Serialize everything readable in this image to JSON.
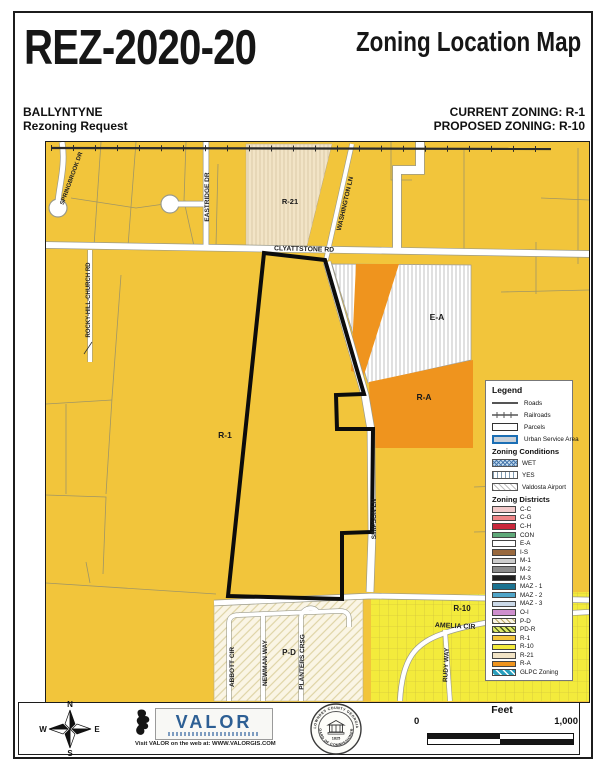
{
  "header": {
    "case_number": "REZ-2020-20",
    "map_title": "Zoning Location Map",
    "applicant": "BALLYNTYNE",
    "request_type": "Rezoning Request",
    "current_zoning_label": "CURRENT ZONING:  R-1",
    "proposed_zoning_label": "PROPOSED ZONING:  R-10"
  },
  "map": {
    "zone_labels": {
      "r21": "R-21",
      "ea": "E-A",
      "ra": "R-A",
      "r1": "R-1",
      "r10": "R-10",
      "pd": "P-D"
    },
    "road_labels": {
      "clyattstone": "CLYATTSTONE RD",
      "eastridge": "EASTRIDGE DR",
      "springbrook": "SPRINGBROOK DR",
      "rockyhill": "ROCKY-HILL-CHURCH RD",
      "washington": "WASHINGTON LN",
      "simpson": "SIMPSON LN",
      "amelia": "AMELIA CIR",
      "rudy": "RUDY WAY",
      "abbott": "ABBOTT CIR",
      "newman": "NEWMAN WAY",
      "planters": "PLANTERS CRSG"
    }
  },
  "legend": {
    "title": "Legend",
    "base_items": [
      {
        "label": "Roads"
      },
      {
        "label": "Railroads"
      },
      {
        "label": "Parcels"
      },
      {
        "label": "Urban Service Area"
      }
    ],
    "conditions_title": "Zoning Conditions",
    "conditions": [
      {
        "label": "WET",
        "color": "#C7DEF0"
      },
      {
        "label": "YES",
        "color": "#FFFFFF"
      },
      {
        "label": "Valdosta Airport",
        "color": "#FFFFFF"
      }
    ],
    "districts_title": "Zoning Districts",
    "districts": [
      {
        "label": "C-C",
        "color": "#F2CACA"
      },
      {
        "label": "C-G",
        "color": "#EE8486"
      },
      {
        "label": "C-H",
        "color": "#C9273B"
      },
      {
        "label": "CON",
        "color": "#5FA979"
      },
      {
        "label": "E-A",
        "color": "#FFFFFF"
      },
      {
        "label": "I-S",
        "color": "#99693E"
      },
      {
        "label": "M-1",
        "color": "#CDCDCD"
      },
      {
        "label": "M-2",
        "color": "#8C8C8C"
      },
      {
        "label": "M-3",
        "color": "#1F1F1F"
      },
      {
        "label": "MAZ - 1",
        "color": "#1B7391"
      },
      {
        "label": "MAZ - 2",
        "color": "#4FA5C9"
      },
      {
        "label": "MAZ - 3",
        "color": "#CBD9E9"
      },
      {
        "label": "O-I",
        "color": "#CE8FCE"
      },
      {
        "label": "P-D",
        "color": "#FAF5E5",
        "hatch": "pd"
      },
      {
        "label": "PD-R",
        "color": "#DCE76A",
        "hatch": "pdr"
      },
      {
        "label": "R-1",
        "color": "#F2C53B"
      },
      {
        "label": "R-10",
        "color": "#F3EB3C"
      },
      {
        "label": "R-21",
        "color": "#F2E4C6"
      },
      {
        "label": "R-A",
        "color": "#EF941E"
      },
      {
        "label": "GLPC Zoning",
        "color": "#2AA0BE",
        "hatch": "glpc"
      }
    ]
  },
  "footer": {
    "compass": {
      "n": "N",
      "e": "E",
      "s": "S",
      "w": "W"
    },
    "valor": {
      "name": "VALOR",
      "web": "Visit VALOR on the web at: WWW.VALORGIS.COM"
    },
    "seal": {
      "top": "LOWNDES COUNTY GEORGIA",
      "bottom": "BOARD OF COMMISSIONERS",
      "year": "1825"
    },
    "scale": {
      "title": "Feet",
      "start": "0",
      "end": "1,000"
    }
  },
  "colors": {
    "r1": "#F2C53B",
    "r10": "#F3EB3C",
    "r21": "#F2E4C6",
    "ra": "#EF941E",
    "pd": "#FAF5E5",
    "usa": "#1B6FB5",
    "valor": "#2D5F94",
    "parcel": "#97906A",
    "casing": "#9A9A8A",
    "outline": "#0C0C0C"
  }
}
